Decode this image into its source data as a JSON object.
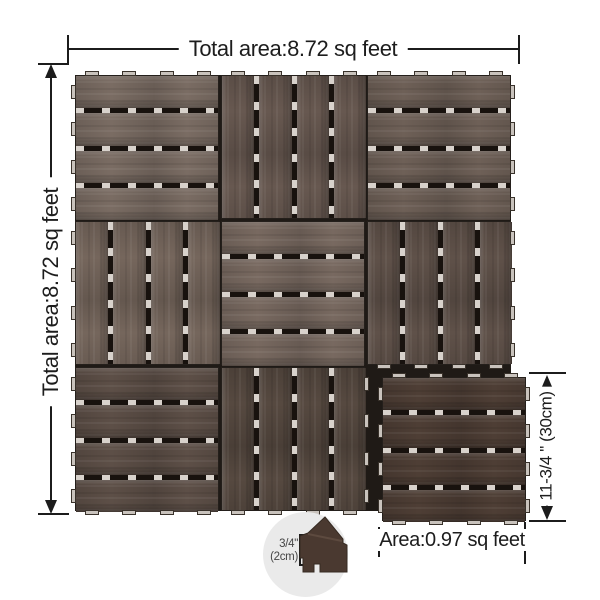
{
  "page": {
    "background": "#ffffff",
    "line_color": "#1c1c1c",
    "text_color": "#1d1d1d"
  },
  "dimensions": {
    "total_width_label": "Total area:8.72 sq feet",
    "total_height_label": "Total area:8.72 sq feet",
    "tile_side_label": "11-3/4 \" (30cm)",
    "tile_area_label": "Area:0.97 sq feet",
    "thickness_value": "3/4\"",
    "thickness_metric": "(2cm)"
  },
  "tile_grid": {
    "rows": 3,
    "cols": 3,
    "slats_per_tile": 4,
    "missing_cell": {
      "row": 2,
      "col": 2
    },
    "colors": {
      "gap_dark": "#18120e",
      "gap_light": "#d8d2cc",
      "tab_fill": "#c9c3bd",
      "tab_border": "#39322b",
      "backing": "#1f1a16",
      "tile_border": "#241f1b"
    },
    "tiles": [
      {
        "row": 0,
        "col": 0,
        "orientation": "horizontal",
        "color": "#7a6c63",
        "tabs": [
          "top",
          "left"
        ]
      },
      {
        "row": 0,
        "col": 1,
        "orientation": "vertical",
        "color": "#675850",
        "tabs": [
          "top"
        ]
      },
      {
        "row": 0,
        "col": 2,
        "orientation": "horizontal",
        "color": "#6e6057",
        "tabs": [
          "top",
          "right"
        ]
      },
      {
        "row": 1,
        "col": 0,
        "orientation": "vertical",
        "color": "#75665c",
        "tabs": [
          "left"
        ]
      },
      {
        "row": 1,
        "col": 1,
        "orientation": "horizontal",
        "color": "#786960",
        "tabs": []
      },
      {
        "row": 1,
        "col": 2,
        "orientation": "vertical",
        "color": "#5f5149",
        "tabs": [
          "right",
          "bottom"
        ]
      },
      {
        "row": 2,
        "col": 0,
        "orientation": "horizontal",
        "color": "#5d4f47",
        "tabs": [
          "left",
          "bottom"
        ]
      },
      {
        "row": 2,
        "col": 1,
        "orientation": "vertical",
        "color": "#564940",
        "tabs": [
          "bottom",
          "right"
        ]
      }
    ],
    "detached_tile": {
      "orientation": "horizontal",
      "color": "#4e3e35",
      "tabs": [
        "top",
        "right",
        "bottom",
        "left"
      ]
    }
  }
}
